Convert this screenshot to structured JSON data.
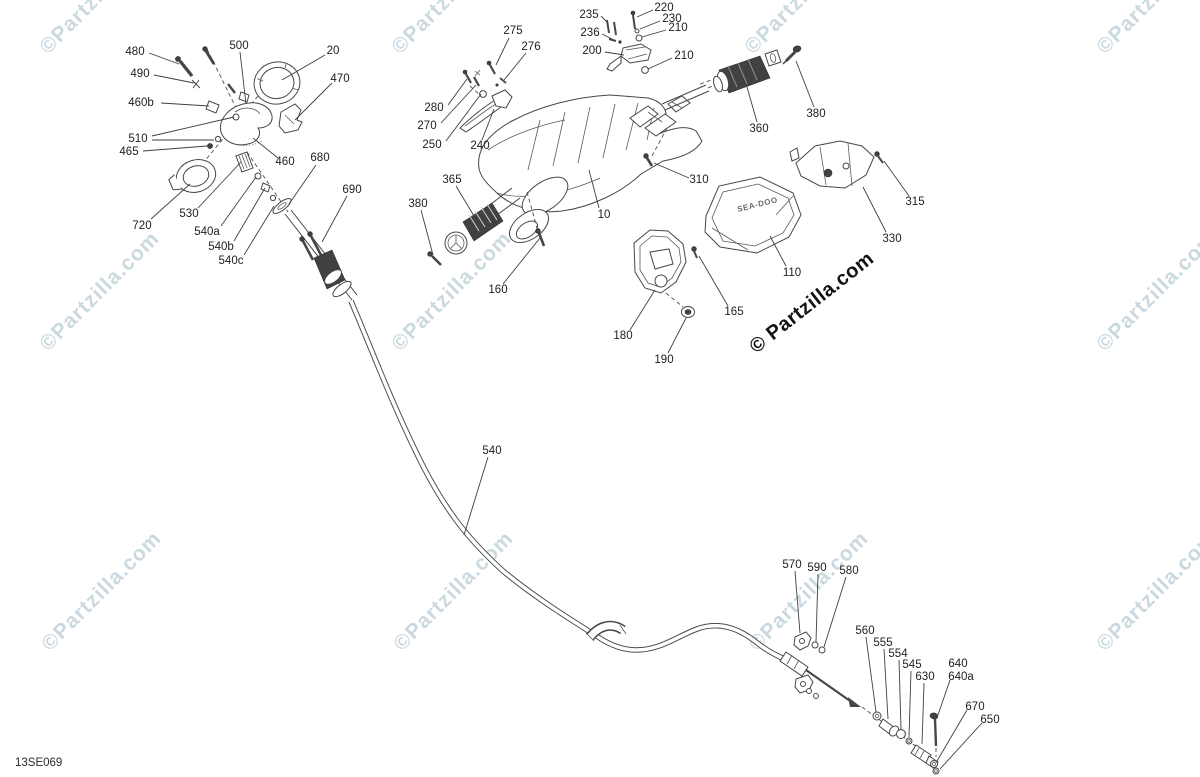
{
  "diagram": {
    "code": "13SE069",
    "brand_logo": "SEA-DOO"
  },
  "watermarks": {
    "light": {
      "text": "©Partzilla.com",
      "color": "#b9cdd6",
      "rotation": -45,
      "instances": [
        {
          "x": 48,
          "y": 55
        },
        {
          "x": 400,
          "y": 55
        },
        {
          "x": 753,
          "y": 55
        },
        {
          "x": 1105,
          "y": 55
        },
        {
          "x": 48,
          "y": 352
        },
        {
          "x": 400,
          "y": 352
        },
        {
          "x": 1105,
          "y": 352
        },
        {
          "x": 50,
          "y": 652
        },
        {
          "x": 402,
          "y": 652
        },
        {
          "x": 757,
          "y": 652
        },
        {
          "x": 1105,
          "y": 652
        }
      ]
    },
    "dark": {
      "text": "© Partzilla.com",
      "color": "#121212",
      "rotation": -38,
      "x": 756,
      "y": 354
    }
  },
  "callouts": [
    {
      "text": "480",
      "x": 135,
      "y": 52,
      "leaders": [
        [
          149,
          53,
          179,
          64
        ]
      ]
    },
    {
      "text": "490",
      "x": 140,
      "y": 74,
      "leaders": [
        [
          154,
          75,
          194,
          83
        ]
      ]
    },
    {
      "text": "460b",
      "x": 141,
      "y": 103,
      "leaders": [
        [
          161,
          103,
          209,
          106
        ]
      ]
    },
    {
      "text": "510",
      "x": 138,
      "y": 139,
      "leaders": [
        [
          152,
          136,
          234,
          117
        ],
        [
          152,
          140,
          214,
          140
        ]
      ]
    },
    {
      "text": "465",
      "x": 129,
      "y": 152,
      "leaders": [
        [
          143,
          151,
          207,
          146
        ]
      ]
    },
    {
      "text": "720",
      "x": 142,
      "y": 226,
      "leaders": [
        [
          151,
          219,
          190,
          184
        ]
      ]
    },
    {
      "text": "530",
      "x": 189,
      "y": 214,
      "leaders": [
        [
          198,
          208,
          241,
          162
        ]
      ]
    },
    {
      "text": "540a",
      "x": 207,
      "y": 232,
      "leaders": [
        [
          221,
          226,
          256,
          177
        ]
      ]
    },
    {
      "text": "540b",
      "x": 221,
      "y": 247,
      "leaders": [
        [
          234,
          241,
          265,
          188
        ]
      ]
    },
    {
      "text": "540c",
      "x": 231,
      "y": 261,
      "leaders": [
        [
          244,
          255,
          274,
          206
        ]
      ]
    },
    {
      "text": "500",
      "x": 239,
      "y": 46,
      "leaders": [
        [
          240,
          52,
          246,
          104
        ]
      ]
    },
    {
      "text": "20",
      "x": 333,
      "y": 51,
      "leaders": [
        [
          325,
          55,
          282,
          80
        ]
      ]
    },
    {
      "text": "470",
      "x": 340,
      "y": 79,
      "leaders": [
        [
          332,
          83,
          295,
          120
        ]
      ]
    },
    {
      "text": "460",
      "x": 285,
      "y": 162,
      "leaders": [
        [
          278,
          158,
          253,
          138
        ]
      ]
    },
    {
      "text": "680",
      "x": 320,
      "y": 158,
      "leaders": [
        [
          316,
          165,
          289,
          204
        ]
      ]
    },
    {
      "text": "690",
      "x": 352,
      "y": 190,
      "leaders": [
        [
          347,
          196,
          322,
          242
        ]
      ]
    },
    {
      "text": "280",
      "x": 434,
      "y": 108,
      "leaders": [
        [
          448,
          105,
          467,
          79
        ]
      ]
    },
    {
      "text": "270",
      "x": 427,
      "y": 126,
      "leaders": [
        [
          441,
          123,
          476,
          85
        ]
      ]
    },
    {
      "text": "250",
      "x": 432,
      "y": 145,
      "leaders": [
        [
          446,
          141,
          481,
          94
        ]
      ]
    },
    {
      "text": "240",
      "x": 480,
      "y": 146,
      "leaders": [
        [
          482,
          140,
          494,
          109
        ]
      ]
    },
    {
      "text": "275",
      "x": 513,
      "y": 31,
      "leaders": [
        [
          509,
          38,
          496,
          65
        ]
      ]
    },
    {
      "text": "276",
      "x": 531,
      "y": 47,
      "leaders": [
        [
          526,
          53,
          504,
          80
        ]
      ]
    },
    {
      "text": "235",
      "x": 589,
      "y": 15,
      "leaders": [
        [
          601,
          16,
          608,
          23
        ]
      ]
    },
    {
      "text": "236",
      "x": 590,
      "y": 33,
      "leaders": [
        [
          602,
          34,
          612,
          39
        ]
      ]
    },
    {
      "text": "200",
      "x": 592,
      "y": 51,
      "leaders": [
        [
          605,
          52,
          624,
          55
        ]
      ]
    },
    {
      "text": "220",
      "x": 664,
      "y": 8,
      "leaders": [
        [
          653,
          10,
          637,
          17
        ]
      ]
    },
    {
      "text": "230",
      "x": 672,
      "y": 19,
      "leaders": [
        [
          660,
          21,
          640,
          29
        ]
      ]
    },
    {
      "text": "210",
      "x": 678,
      "y": 28,
      "leaders": [
        [
          666,
          30,
          642,
          37
        ]
      ]
    },
    {
      "text": "210",
      "x": 684,
      "y": 56,
      "leaders": [
        [
          672,
          58,
          648,
          69
        ]
      ]
    },
    {
      "text": "360",
      "x": 759,
      "y": 129,
      "leaders": [
        [
          757,
          122,
          747,
          87
        ]
      ]
    },
    {
      "text": "380",
      "x": 816,
      "y": 114,
      "leaders": [
        [
          814,
          107,
          796,
          61
        ]
      ]
    },
    {
      "text": "380",
      "x": 418,
      "y": 204,
      "leaders": [
        [
          421,
          210,
          433,
          255
        ]
      ]
    },
    {
      "text": "365",
      "x": 452,
      "y": 180,
      "leaders": [
        [
          456,
          186,
          477,
          221
        ]
      ]
    },
    {
      "text": "160",
      "x": 498,
      "y": 290,
      "leaders": [
        [
          503,
          284,
          540,
          238
        ]
      ]
    },
    {
      "text": "310",
      "x": 699,
      "y": 180,
      "leaders": [
        [
          689,
          178,
          654,
          163
        ]
      ]
    },
    {
      "text": "10",
      "x": 604,
      "y": 215,
      "leaders": [
        [
          599,
          208,
          589,
          170
        ]
      ]
    },
    {
      "text": "110",
      "x": 792,
      "y": 273,
      "leaders": [
        [
          786,
          266,
          770,
          236
        ]
      ]
    },
    {
      "text": "165",
      "x": 734,
      "y": 312,
      "leaders": [
        [
          728,
          306,
          699,
          256
        ]
      ]
    },
    {
      "text": "180",
      "x": 623,
      "y": 336,
      "leaders": [
        [
          630,
          330,
          655,
          290
        ]
      ]
    },
    {
      "text": "190",
      "x": 664,
      "y": 360,
      "leaders": [
        [
          668,
          353,
          686,
          318
        ]
      ]
    },
    {
      "text": "330",
      "x": 892,
      "y": 239,
      "leaders": [
        [
          886,
          232,
          863,
          187
        ]
      ]
    },
    {
      "text": "315",
      "x": 915,
      "y": 202,
      "leaders": [
        [
          909,
          196,
          884,
          161
        ]
      ]
    },
    {
      "text": "540",
      "x": 492,
      "y": 451,
      "leaders": [
        [
          488,
          457,
          464,
          535
        ]
      ]
    },
    {
      "text": "570",
      "x": 792,
      "y": 565,
      "leaders": [
        [
          795,
          571,
          800,
          633
        ]
      ]
    },
    {
      "text": "590",
      "x": 817,
      "y": 568,
      "leaders": [
        [
          818,
          574,
          816,
          642
        ]
      ]
    },
    {
      "text": "580",
      "x": 849,
      "y": 571,
      "leaders": [
        [
          846,
          577,
          824,
          647
        ]
      ]
    },
    {
      "text": "560",
      "x": 865,
      "y": 631,
      "leaders": [
        [
          866,
          637,
          876,
          712
        ]
      ]
    },
    {
      "text": "555",
      "x": 883,
      "y": 643,
      "leaders": [
        [
          884,
          649,
          888,
          719
        ]
      ]
    },
    {
      "text": "554",
      "x": 898,
      "y": 654,
      "leaders": [
        [
          899,
          660,
          901,
          729
        ]
      ]
    },
    {
      "text": "545",
      "x": 912,
      "y": 665,
      "leaders": [
        [
          911,
          671,
          909,
          737
        ]
      ]
    },
    {
      "text": "630",
      "x": 925,
      "y": 677,
      "leaders": [
        [
          924,
          683,
          922,
          744
        ]
      ]
    },
    {
      "text": "640",
      "x": 958,
      "y": 664,
      "leaders": []
    },
    {
      "text": "640a",
      "x": 961,
      "y": 677,
      "leaders": [
        [
          950,
          680,
          938,
          715
        ]
      ]
    },
    {
      "text": "670",
      "x": 975,
      "y": 707,
      "leaders": [
        [
          967,
          710,
          937,
          761
        ]
      ]
    },
    {
      "text": "650",
      "x": 990,
      "y": 720,
      "leaders": [
        [
          982,
          723,
          940,
          769
        ]
      ]
    }
  ]
}
